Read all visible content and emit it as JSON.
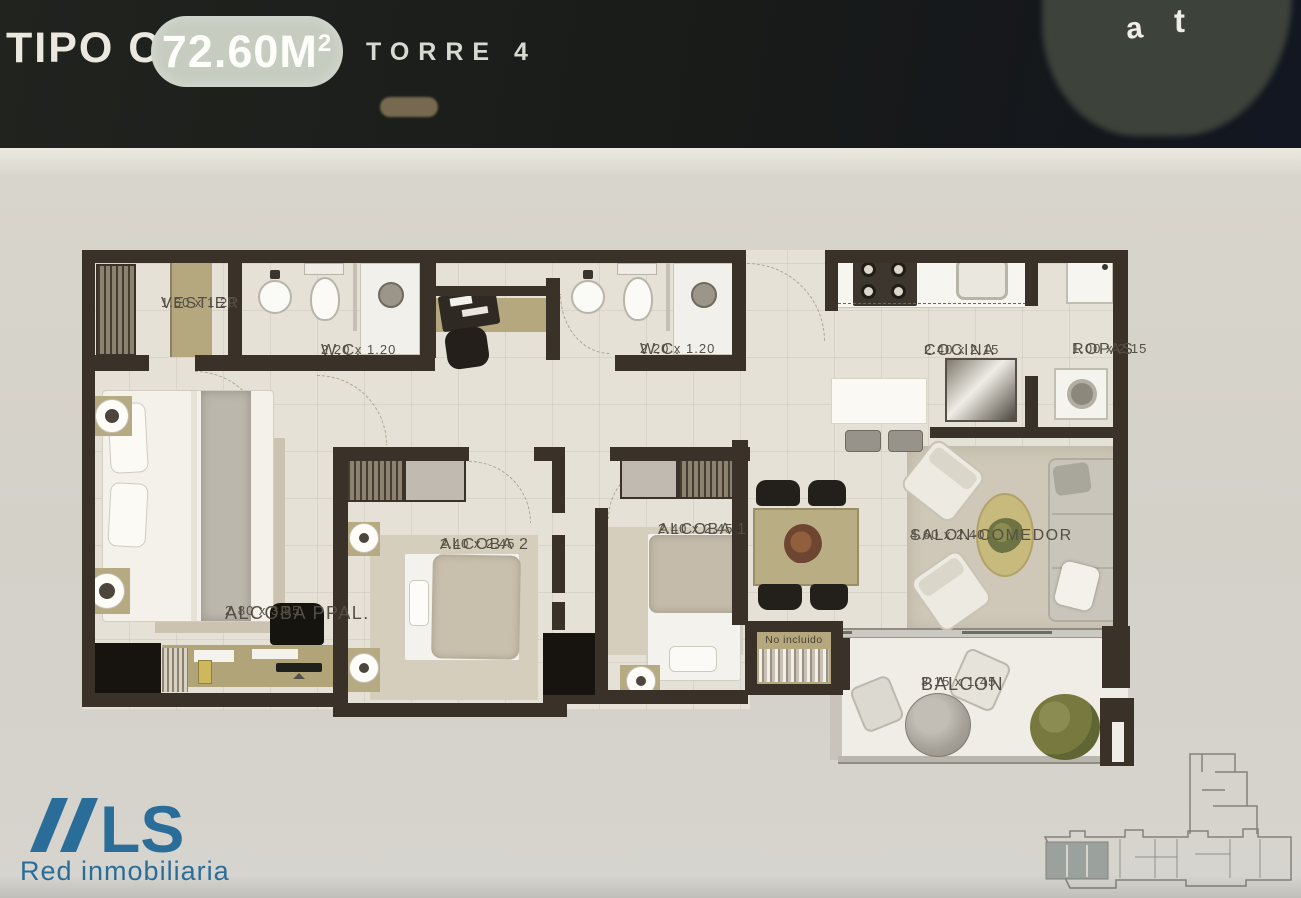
{
  "header": {
    "type_label": "TIPO C",
    "area_value": "72.60M",
    "area_sup": "2",
    "tower_label": "TORRE 4",
    "corner_fragment_1": "a",
    "corner_fragment_2": "t"
  },
  "plan": {
    "rooms": {
      "vestier": {
        "name": "VESTIER",
        "dims": "1.60 x 1.20"
      },
      "wc1": {
        "name": "W.C.",
        "dims": "2.20 x 1.20"
      },
      "wc2": {
        "name": "W.C.",
        "dims": "2.20 x 1.20"
      },
      "cocina": {
        "name": "COCINA",
        "dims": "2.40 x 2.15"
      },
      "ropas": {
        "name": "ROPAS",
        "dims": "1.00 x 2.15"
      },
      "alcoba2": {
        "name": "ALCOBA 2",
        "dims": "2.40 x 2.45"
      },
      "alcoba1": {
        "name": "ALCOBA 1",
        "dims": "2.40 x 2.45"
      },
      "salon": {
        "name": "SALON-COMEDOR",
        "dims": "4.60 x 2.40"
      },
      "alcoba_ppal": {
        "name": "ALCOBA PPAL.",
        "dims": "2.80 x 3.85"
      },
      "balcon": {
        "name": "BALCON",
        "dims": "3.15 x 1.45"
      }
    },
    "note_not_included": "No incluido"
  },
  "footer": {
    "logo_text": "LS",
    "tagline": "Red inmobiliaria",
    "logo_color": "#2b6d99"
  }
}
